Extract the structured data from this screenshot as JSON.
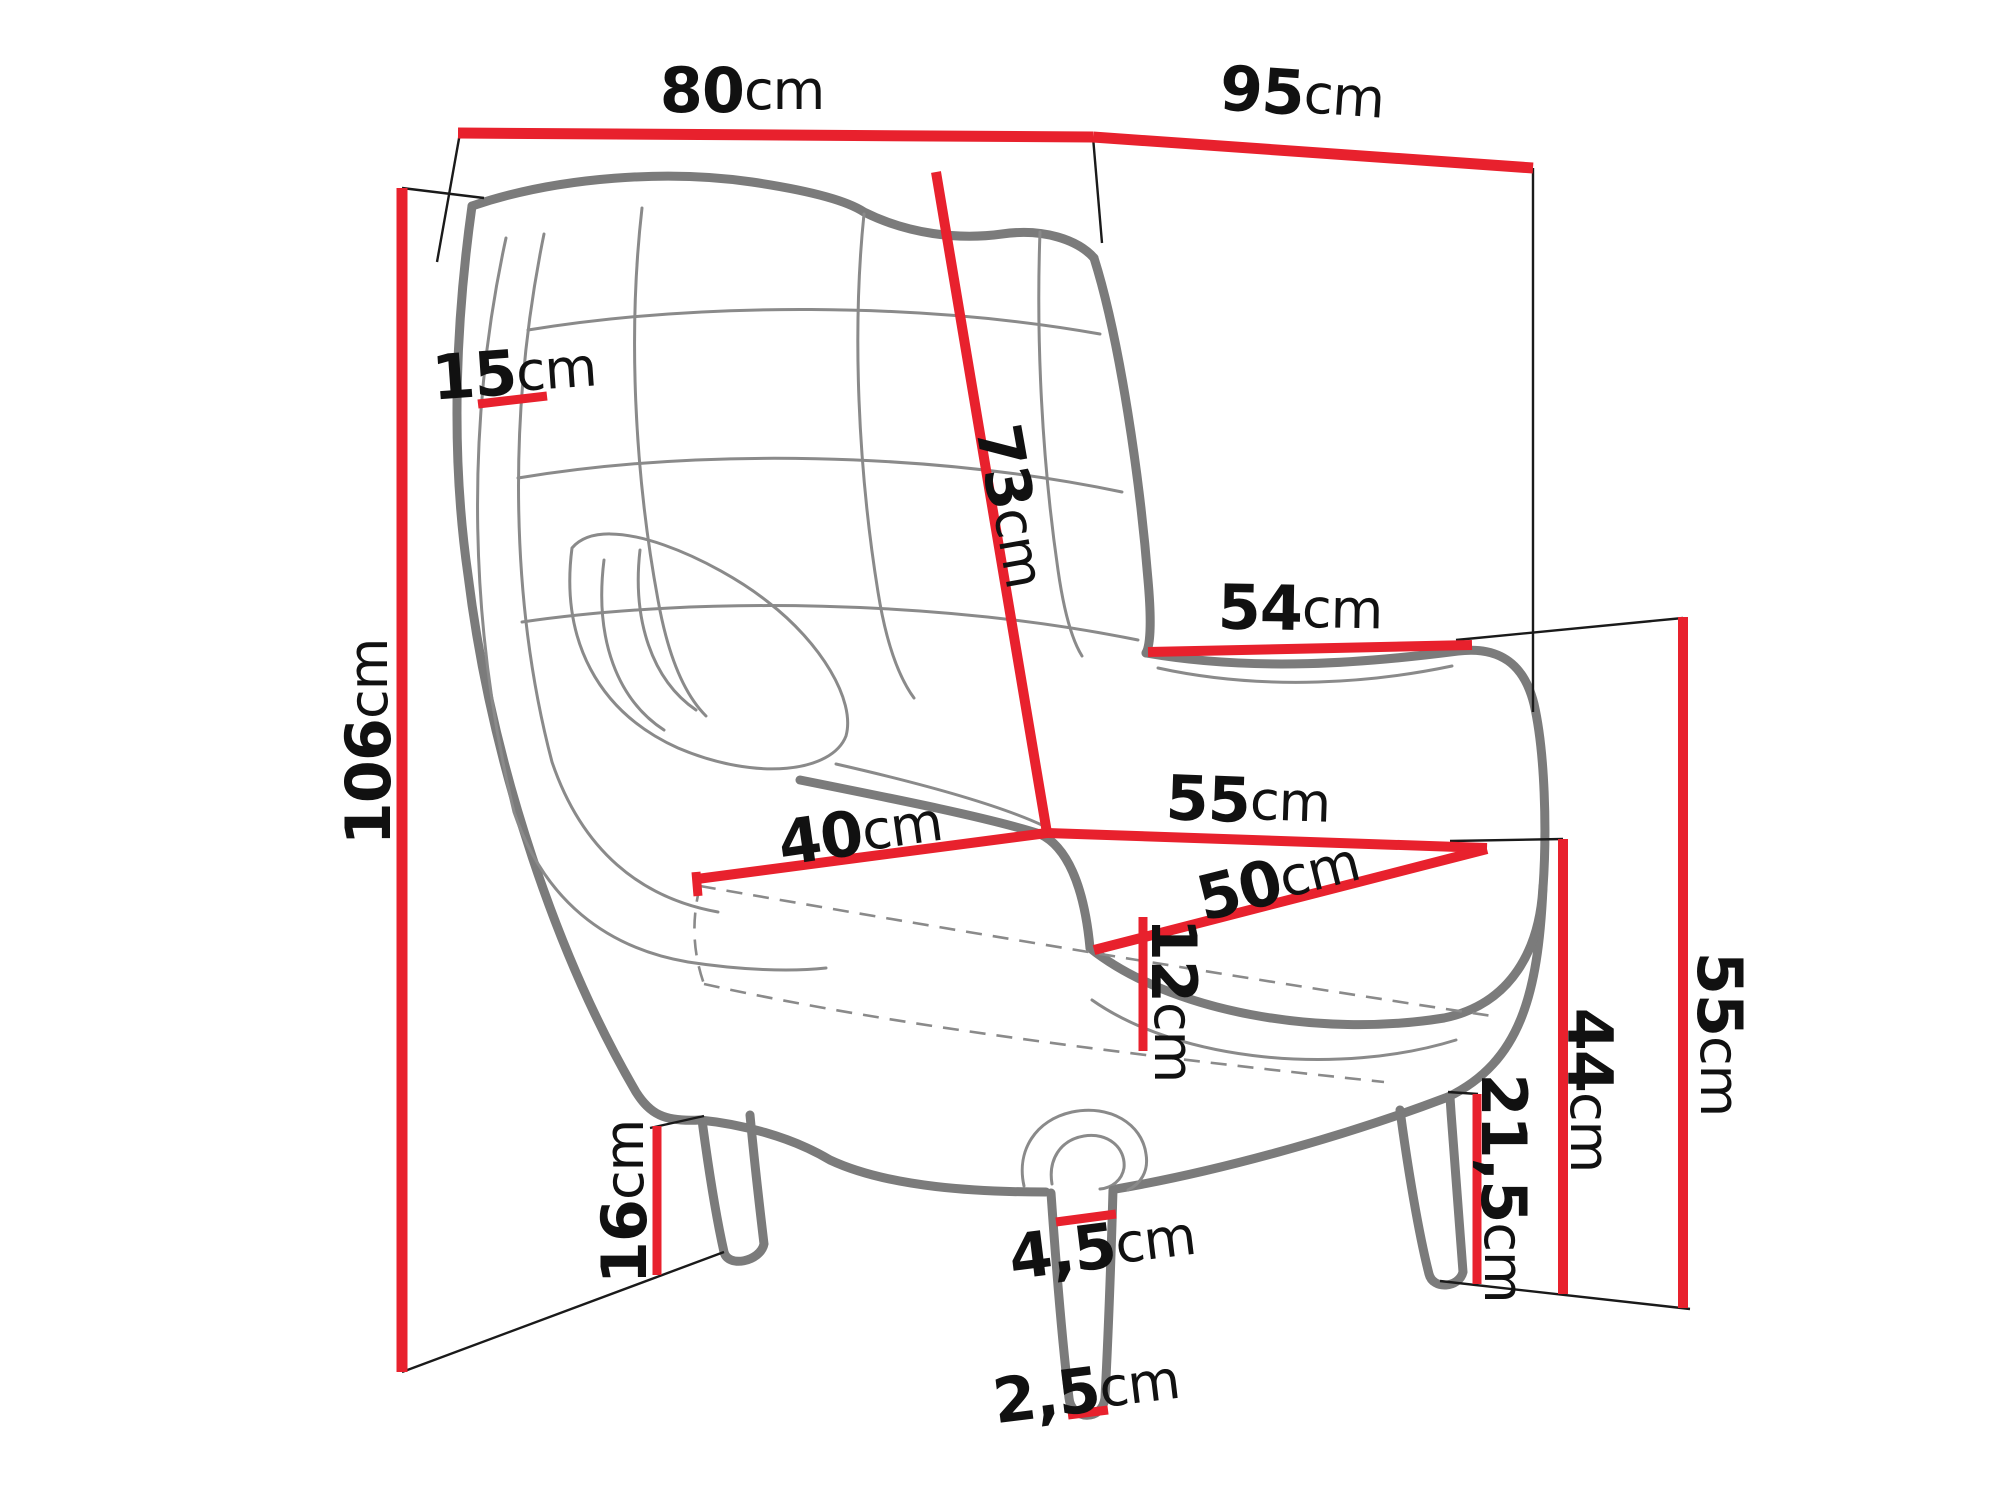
{
  "diagram": {
    "unit_suffix": "cm",
    "colors": {
      "dimension_line": "#e8212d",
      "chair_outline": "#7b7b7b",
      "chair_detail": "#8a8a8a",
      "extension_line": "#1a1a1a",
      "label_text": "#111111",
      "background": "#ffffff"
    },
    "dimensions": {
      "top_width": {
        "value": "80",
        "unit": "cm"
      },
      "top_depth": {
        "value": "95",
        "unit": "cm"
      },
      "total_height": {
        "value": "106",
        "unit": "cm"
      },
      "backrest_thickness": {
        "value": "15",
        "unit": "cm"
      },
      "backrest_height": {
        "value": "73",
        "unit": "cm"
      },
      "armrest_depth": {
        "value": "54",
        "unit": "cm"
      },
      "seat_width": {
        "value": "55",
        "unit": "cm"
      },
      "seat_depth": {
        "value": "50",
        "unit": "cm"
      },
      "armrest_inner_length": {
        "value": "40",
        "unit": "cm"
      },
      "cushion_thickness": {
        "value": "12",
        "unit": "cm"
      },
      "rear_leg_height": {
        "value": "16",
        "unit": "cm"
      },
      "front_leg_top_width": {
        "value": "4,5",
        "unit": "cm"
      },
      "front_leg_bottom_width": {
        "value": "2,5",
        "unit": "cm"
      },
      "base_clearance_height": {
        "value": "21,5",
        "unit": "cm"
      },
      "seat_height": {
        "value": "44",
        "unit": "cm"
      },
      "armrest_height": {
        "value": "55",
        "unit": "cm"
      }
    }
  }
}
